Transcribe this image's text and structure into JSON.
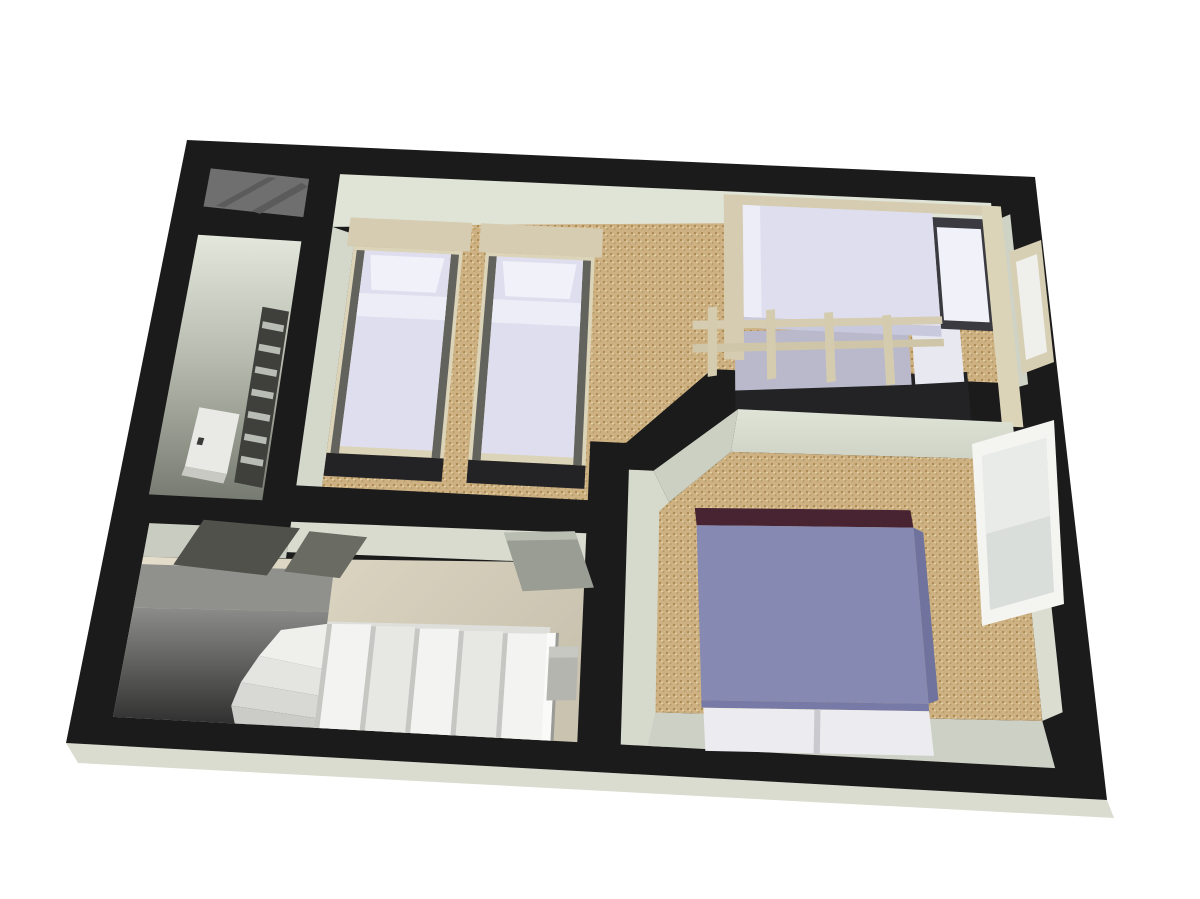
{
  "canvas": {
    "width": 1200,
    "height": 899,
    "background": "#ffffff"
  },
  "scene": {
    "title": "3D floor plan render of an upper storey, isometric dollhouse view",
    "rooms": [
      {
        "id": "twin-bedroom",
        "label": "Bedroom with two single beds and a bunk bed",
        "floor": "tan speckled carpet"
      },
      {
        "id": "double-bedroom",
        "label": "Bedroom with double bed and window",
        "floor": "tan speckled carpet"
      },
      {
        "id": "bathroom",
        "label": "Narrow bathroom with towel radiator and cabinet",
        "floor": "shadowed grey"
      },
      {
        "id": "landing",
        "label": "Landing with winder staircase",
        "floor": "beige"
      },
      {
        "id": "stairwell",
        "label": "Open stairwell void"
      },
      {
        "id": "loft-hatch",
        "label": "Dark sloped stair panel in top-left corner"
      }
    ],
    "furniture": [
      "single bed",
      "single bed",
      "bunk bed",
      "double bed",
      "towel radiator",
      "cabinet",
      "window",
      "open door",
      "open door",
      "door frame"
    ]
  },
  "colors": {
    "background": "#ffffff",
    "wall": "#1b1b1b",
    "wall_underside": "#d9dccf",
    "wall_face_light": "#e0e4d7",
    "wall_face_mid": "#cfd3c6",
    "carpet_base": "#cdb183",
    "carpet_dot_dark": "#a9894f",
    "carpet_dot_mid": "#b59a63",
    "carpet_dot_light": "#e8d7ac",
    "landing_floor_light": "#e6dfcc",
    "landing_floor_dark": "#cac3b0",
    "void_top": "#8c8c8a",
    "void_bottom": "#2d2d2d",
    "stair_white": "#f3f3f1",
    "stair_shade": "#e7e7e4",
    "stair_edge": "#c6c6c2",
    "panel_gray": "#6f6f6f",
    "panel_stripe": "#5b5b5b",
    "bed_frame": "#d5ccb1",
    "bed_frame_light": "#dcd4b9",
    "duvet": "#dedeef",
    "duvet_highlight": "#ededf8",
    "pillow": "#f1f1f9",
    "bed_shadow": "#232326",
    "bunk_lower": "#b9b9cb",
    "double_duvet": "#8689b2",
    "double_duvet_side": "#6f739e",
    "double_duvet_foot": "#777aa6",
    "headboard_maroon": "#482332",
    "window_frame": "#f4f4f1",
    "window_glass": "#dadedb",
    "door_frame": "#d7cfb4",
    "door_gray": "#999d94",
    "door_dark": "#50514b",
    "bath_top": "#e4e7dc",
    "bath_mid": "#b9bdb1",
    "bath_bottom": "#767a70",
    "radiator_back": "#3f403c",
    "radiator_rung": "#b9bcb4",
    "cabinet_white": "#e9e9e5"
  }
}
